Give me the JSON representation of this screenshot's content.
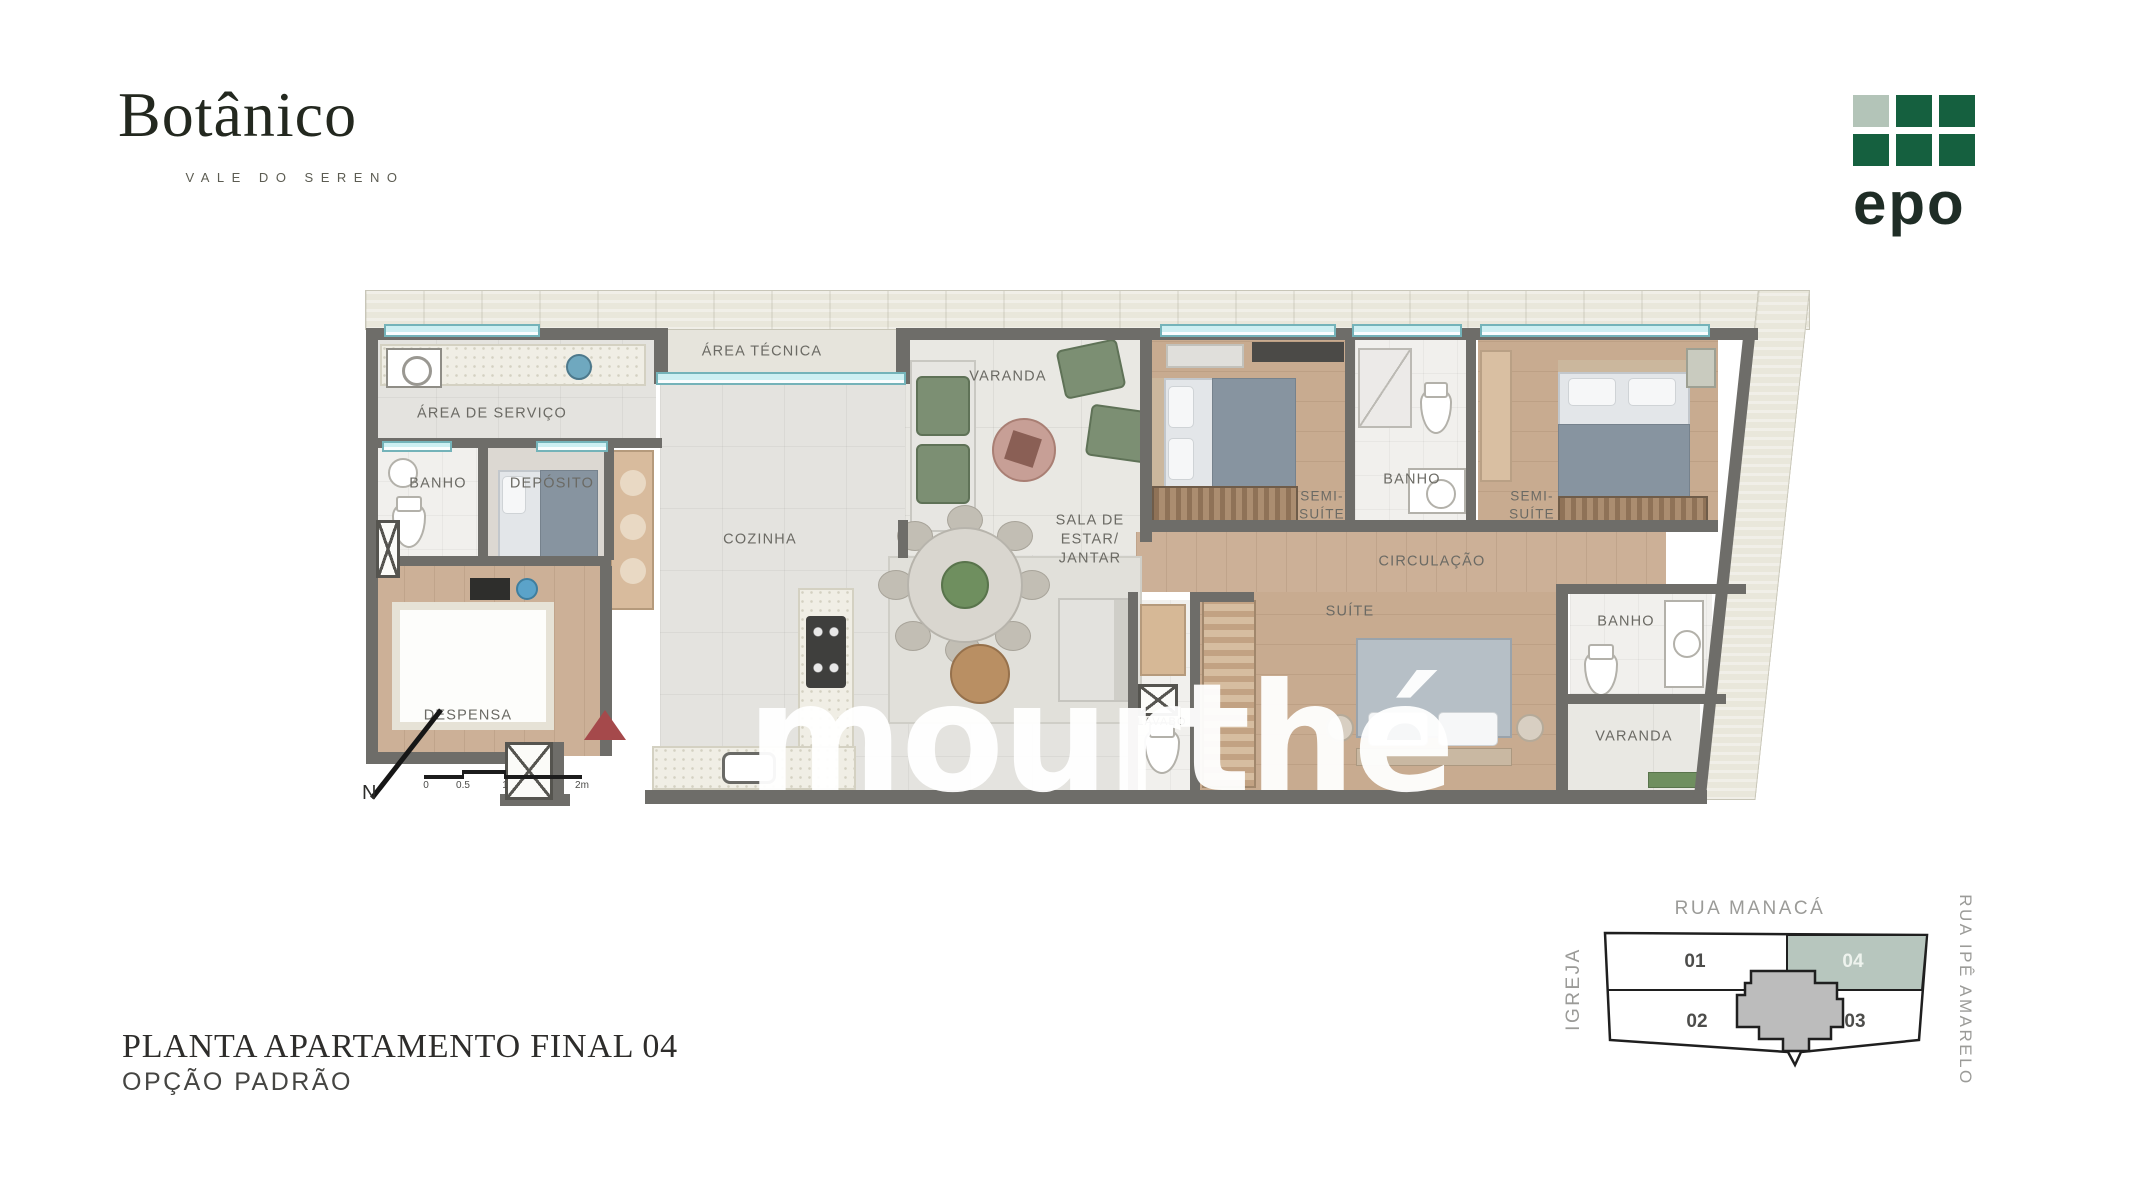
{
  "header": {
    "brand": {
      "name": "Botânico",
      "subtitle": "VALE DO SERENO"
    },
    "developer_logo": {
      "text": "epo",
      "dark_green": "#15603f",
      "light_square": "#b3c4b8"
    }
  },
  "plan": {
    "rooms": {
      "area_servico": {
        "label": "ÁREA DE SERVIÇO"
      },
      "area_tecnica": {
        "label": "ÁREA TÉCNICA"
      },
      "banho_servico": {
        "label": "BANHO"
      },
      "deposito": {
        "label": "DEPÓSITO"
      },
      "despensa": {
        "label": "DESPENSA"
      },
      "cozinha": {
        "label": "COZINHA"
      },
      "varanda": {
        "label": "VARANDA"
      },
      "sala": {
        "label": "SALA DE\nESTAR/\nJANTAR"
      },
      "lavabo": {
        "label": "LAVABO"
      },
      "semi_suite_1": {
        "label": "SEMI-\nSUÍTE"
      },
      "banho_semi": {
        "label": "BANHO"
      },
      "semi_suite_2": {
        "label": "SEMI-\nSUÍTE"
      },
      "circulacao": {
        "label": "CIRCULAÇÃO"
      },
      "suite": {
        "label": "SUÍTE"
      },
      "banho_suite": {
        "label": "BANHO"
      },
      "varanda_suite": {
        "label": "VARANDA"
      }
    },
    "north_label": "N",
    "scale_ticks": [
      "0",
      "0.5",
      "1",
      "2m"
    ],
    "entrance_marker_color": "#a5494b"
  },
  "watermark": {
    "text": "mourthé",
    "subtext": "arquitetos"
  },
  "footer": {
    "title": "PLANTA APARTAMENTO FINAL 04",
    "subtitle": "OPÇÃO PADRÃO"
  },
  "keyplan": {
    "street_top": "RUA MANACÁ",
    "street_left": "IGREJA",
    "street_right": "RUA IPÊ AMARELO",
    "units": {
      "u01": "01",
      "u02": "02",
      "u03": "03",
      "u04": "04"
    },
    "highlighted_unit": "04",
    "highlight_color": "#b7c6be"
  },
  "colors": {
    "wall": "#6e6d69",
    "window": "#cdeff2",
    "wood": "#ccb097",
    "stone": "#e9e7db"
  }
}
